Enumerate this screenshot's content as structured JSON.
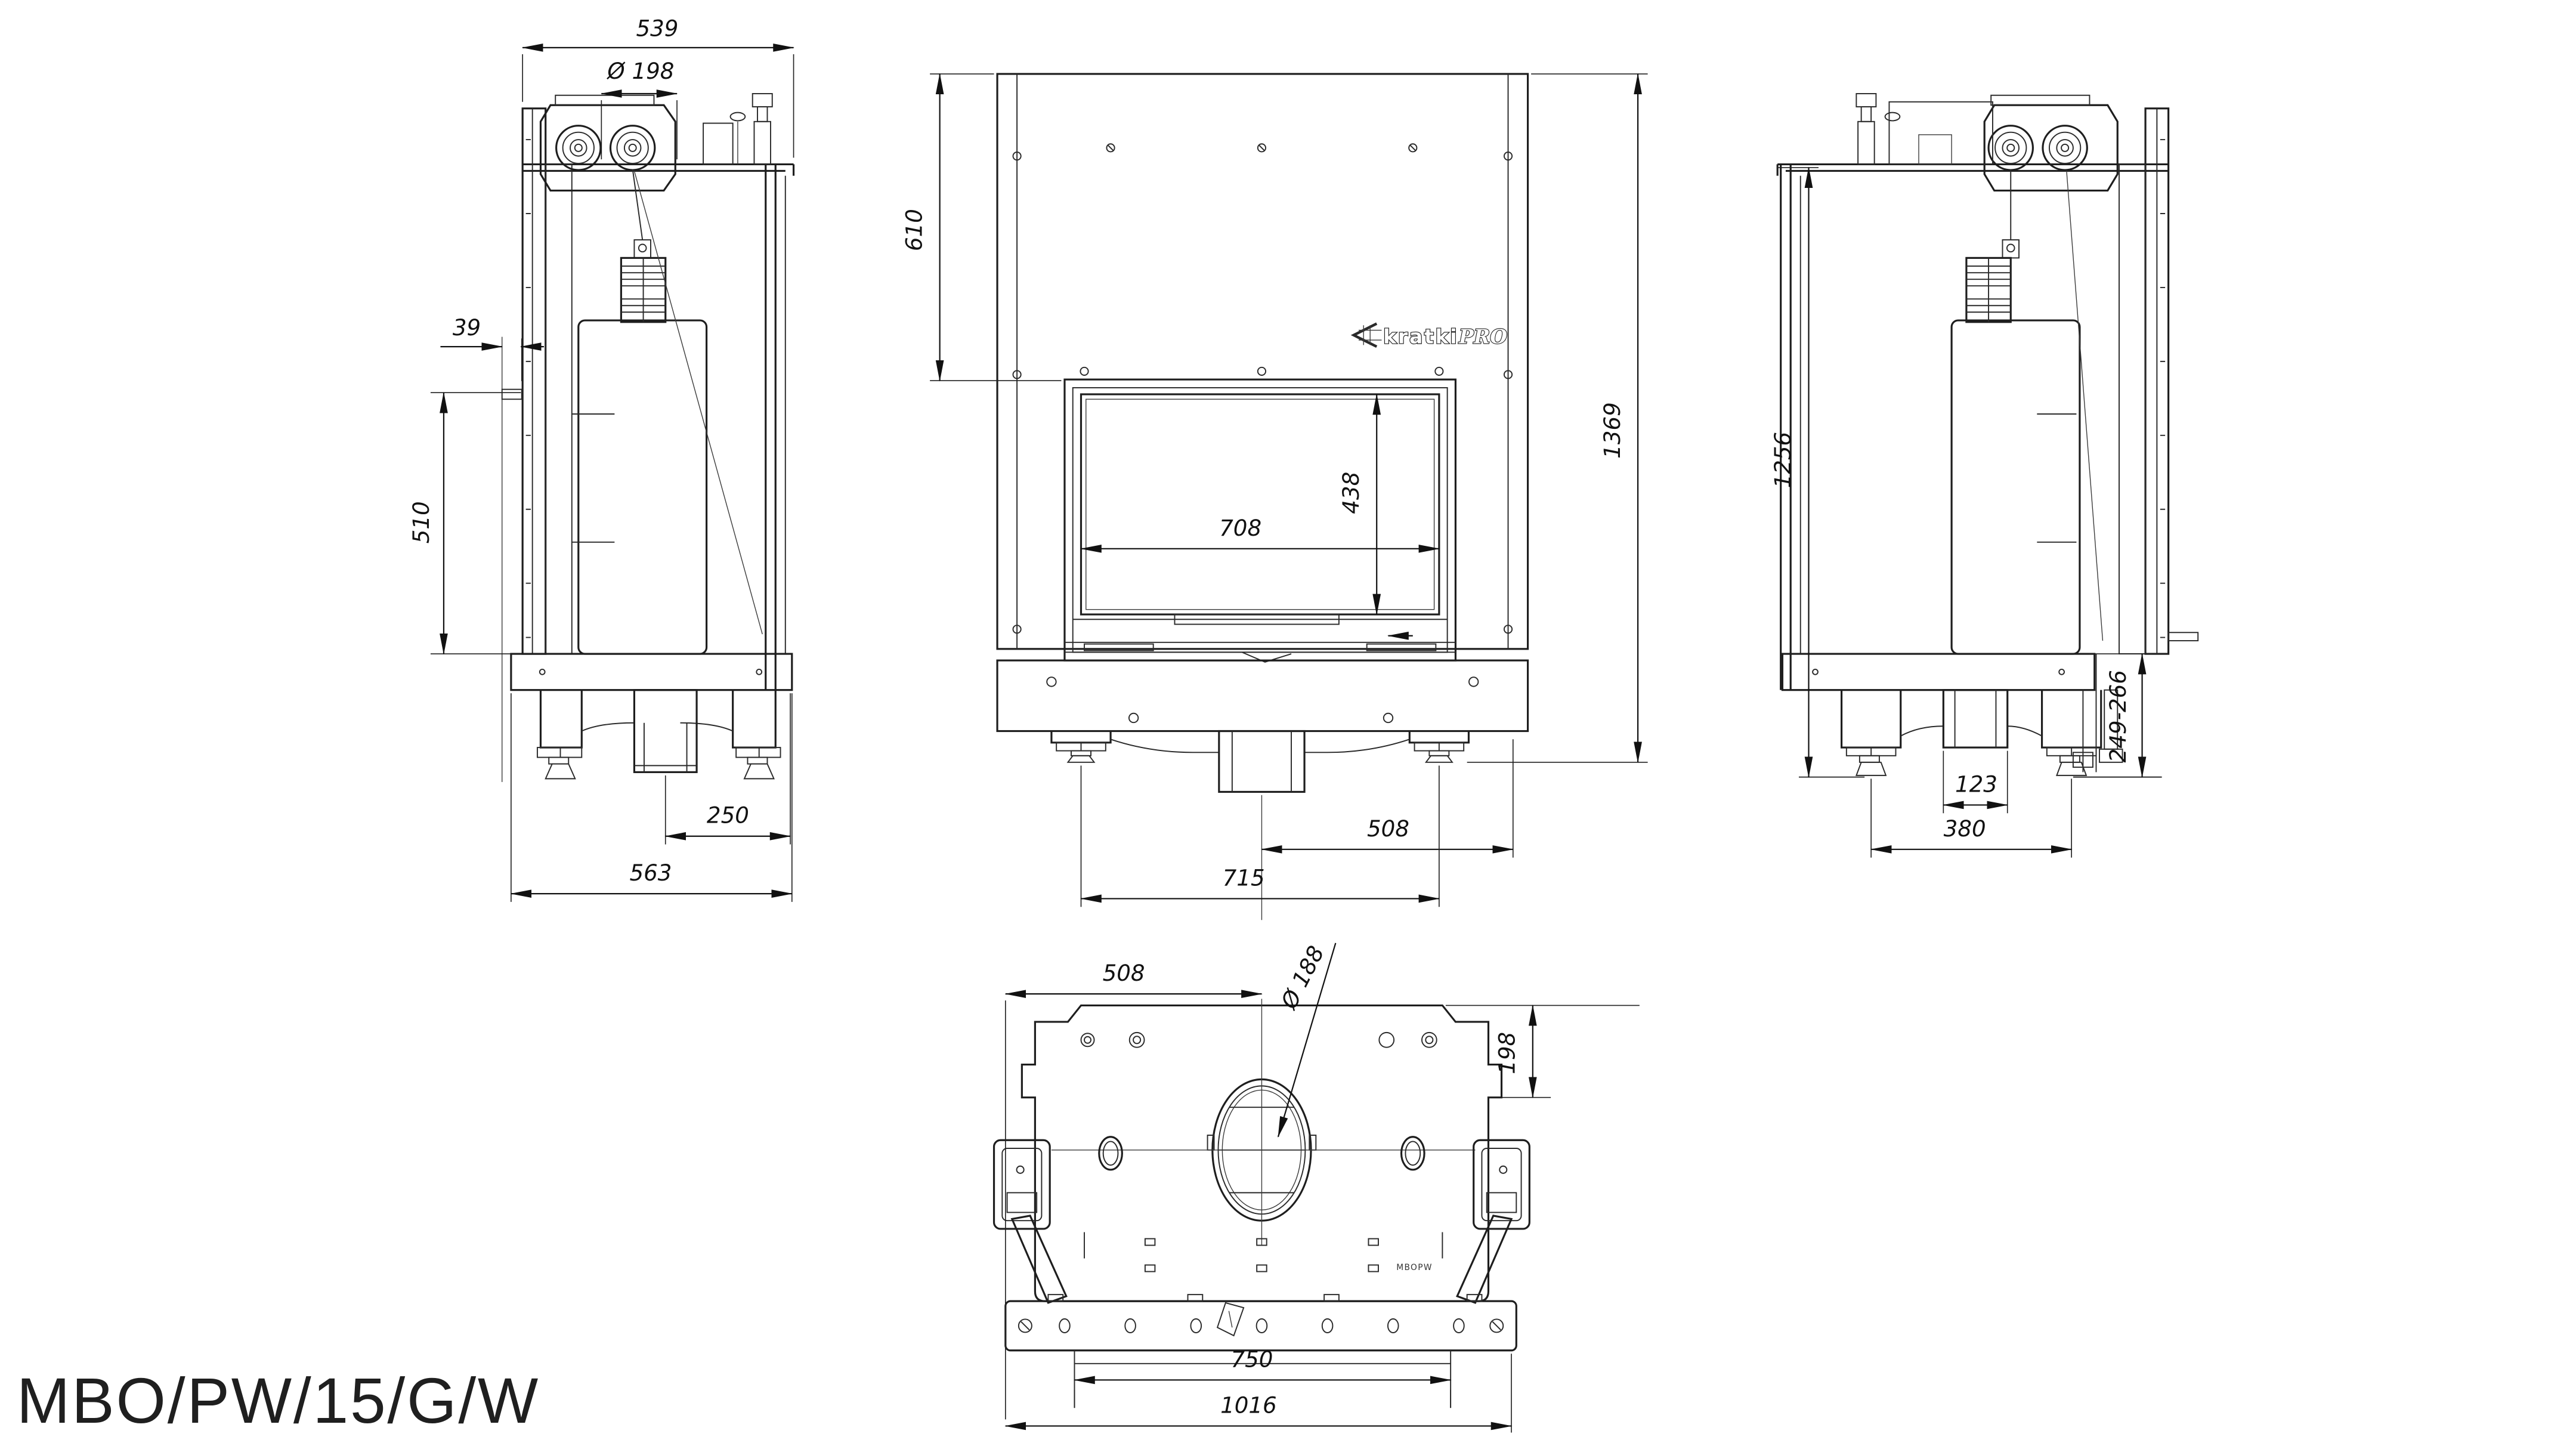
{
  "drawing": {
    "title": "MBO/PW/15/G/W",
    "logo": {
      "brand": "kratki",
      "suffix": "PRO"
    }
  },
  "views": {
    "left_side": {
      "dims": {
        "top_depth": "539",
        "flue_diameter": "Ø 198",
        "wall_offset": "39",
        "bracket_height": "510",
        "rear_foot_offset": "250",
        "total_depth": "563"
      }
    },
    "front": {
      "dims": {
        "top_to_glass": "610",
        "total_height": "1369",
        "glass_width": "708",
        "glass_height": "438",
        "center_to_edge": "508",
        "feet_spacing": "715"
      }
    },
    "right_side": {
      "dims": {
        "body_height": "1256",
        "floor_clearance": "249-266",
        "duct_width": "123",
        "feet_spacing": "380"
      }
    },
    "bottom": {
      "etch": "MBOPW",
      "dims": {
        "edge_to_flue_center": "508",
        "flue_diameter": "Ø 188",
        "flue_center_offset": "198",
        "inner_width": "750",
        "total_width": "1016"
      }
    }
  }
}
